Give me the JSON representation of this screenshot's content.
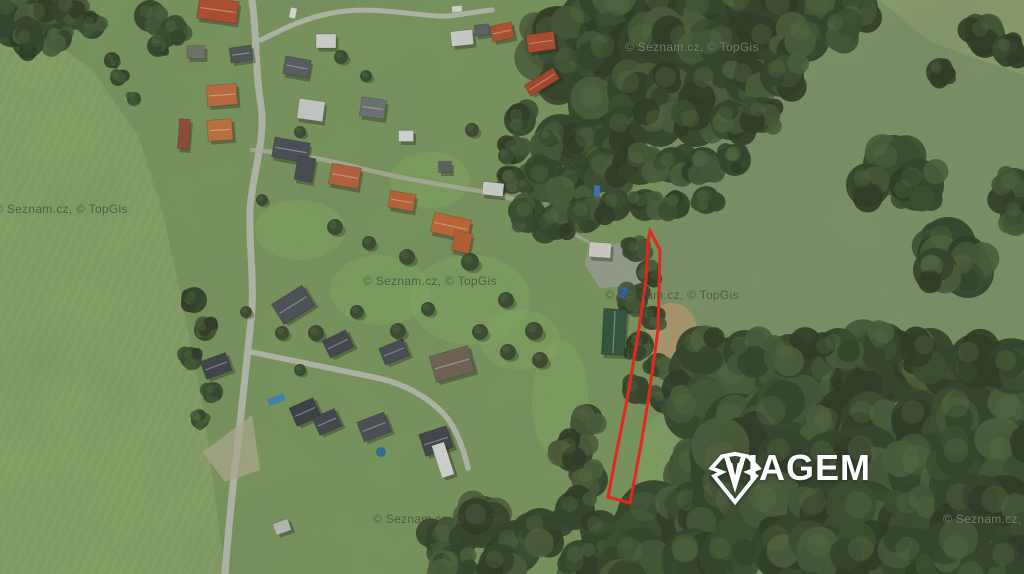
{
  "map": {
    "attribution_text": "© Seznam.cz, © TopGis",
    "watermarks": [
      {
        "x": 625,
        "y": 40,
        "variant": "dark-bg"
      },
      {
        "x": -6,
        "y": 202,
        "variant": "light-bg"
      },
      {
        "x": 363,
        "y": 274,
        "variant": "light-bg"
      },
      {
        "x": 605,
        "y": 288,
        "variant": "light-bg"
      },
      {
        "x": 373,
        "y": 512,
        "variant": "light-bg"
      },
      {
        "x": 943,
        "y": 512,
        "variant": "dark-bg"
      }
    ]
  },
  "branding": {
    "logo_text": "VIAGEM"
  },
  "parcel_outline": {
    "color": "#e5271d",
    "stroke_width": 3,
    "points": "650,231 660,250 658,330 649,395 641,445 630,503 608,497 616,455 627,400 638,335 646,280 648,242"
  },
  "palette": {
    "base_green": "#7b9a5e",
    "field_green": "#8aa766",
    "meadow_green": "#80946a",
    "forest_dark": "#33422a",
    "road_gray": "#b6bab0",
    "dirt_tan": "#b49a6f"
  }
}
